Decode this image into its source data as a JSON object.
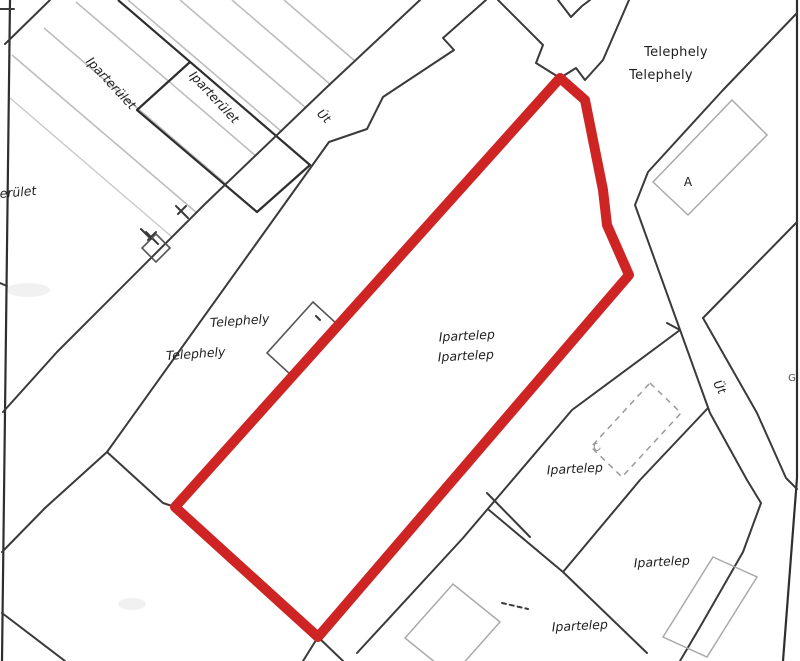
{
  "map": {
    "type": "cadastral-parcel-map-scan",
    "labels": {
      "iparterulet_1": "Iparterület",
      "iparterulet_2": "Iparterület",
      "iparterulet_partial": "erület",
      "telephely_ne_1": "Telephely",
      "telephely_ne_2": "Telephely",
      "telephely_w_1": "Telephely",
      "telephely_w_2": "Telephely",
      "ipartelep_center_1": "Ipartelep",
      "ipartelep_center_2": "Ipartelep",
      "ipartelep_se_1": "Ipartelep",
      "ipartelep_se_2": "Ipartelep",
      "ipartelep_s": "Ipartelep",
      "road_nw": "Út",
      "road_e": "Üt",
      "building_a": "A",
      "building_c": "C",
      "partial_right_edge": "G"
    },
    "colors": {
      "highlight": "#ce2424",
      "line_dark": "#3a3a3a",
      "line_light": "#bdbdbd",
      "background": "#ffffff"
    },
    "highlight_parcel": {
      "stroke_width": 10,
      "vertices": [
        [
          560,
          78
        ],
        [
          585,
          100
        ],
        [
          603,
          190
        ],
        [
          607,
          225
        ],
        [
          629,
          275
        ],
        [
          318,
          637
        ],
        [
          175,
          507
        ]
      ]
    }
  }
}
